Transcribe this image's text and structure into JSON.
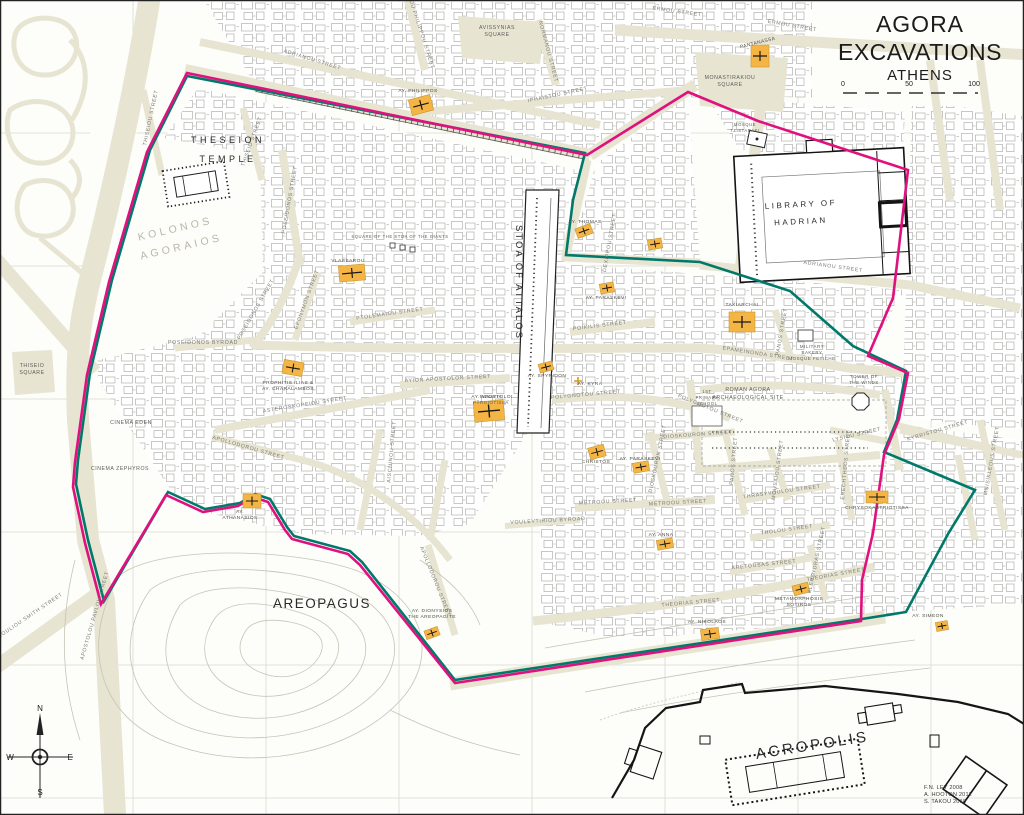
{
  "title": {
    "line1": "AGORA",
    "line2": "EXCAVATIONS",
    "line3": "ATHENS"
  },
  "scale_bar": {
    "tick0": "0",
    "tick50": "50",
    "tick100": "100"
  },
  "compass": {
    "n": "N",
    "e": "E",
    "s": "S",
    "w": "W"
  },
  "credits": {
    "line1": "F.N. LEY 2008",
    "line2": "A. HOOTON 2012",
    "line3": "S. TAKOU 2018"
  },
  "colors": {
    "boundary_magenta": "#e0107f",
    "boundary_teal": "#00796b",
    "church": "#f4b545",
    "street": "#e7e4d1",
    "contour": "#c6c4b6",
    "grid": "#dadad0"
  },
  "major_labels": {
    "theseion_1": "THESEION",
    "theseion_2": "TEMPLE",
    "kolonos_1": "KOLONOS",
    "kolonos_2": "AGORAIOS",
    "library_1": "LIBRARY OF",
    "library_2": "HADRIAN",
    "stoa": "STOA OF ATTALOS",
    "areopagus": "AREOPAGUS",
    "acropolis": "ACROPOLIS"
  },
  "area_labels": {
    "monastiraki_1": "MONASTIRAKIOU",
    "monastiraki_2": "SQUARE",
    "avissynias_1": "AVISSYNIAS",
    "avissynias_2": "SQUARE",
    "thiseio_1": "THISEIO",
    "thiseio_2": "SQUARE",
    "giants": "SQUARE OF THE STOA OF THE GIANTS",
    "roman_1": "ROMAN AGORA",
    "roman_2": "ARCHAEOLOGICAL SITE",
    "military_1": "MILITARY",
    "military_2": "BAKERY",
    "military_3": "MOSQUE FETICHE",
    "tower_1": "TOWER OF",
    "tower_2": "THE WINDS",
    "school_1": "1ST",
    "school_2": "PRIMARY",
    "school_3": "SCHOOL",
    "mosque_1": "MOSQUE",
    "mosque_2": "TZISTARAKI",
    "cinema_eden": "CINEMA EDEN",
    "cinema_zephyros": "CINEMA ZEPHYROS",
    "pyrgiotissa_1": "PANAYIA",
    "pyrgiotissa_2": "PYRGIOTISSA"
  },
  "churches": {
    "pantanassa": "PANTANASSA",
    "philippos": "AY. PHILIPPOS",
    "vlassarou": "VLASSAROU",
    "thomas": "AY. THOMAS",
    "paraskevi_n": "AY. PARASKEVI",
    "prophitis_1": "PROPHITIS ILIAS &",
    "prophitis_2": "AY. CHARALAMBOS",
    "taxiarchai": "TAXIARCHAI",
    "spyridon": "AY. SPYRIDON",
    "kyra": "AY. KYRA",
    "apostoloi": "AY. APOSTOLOI",
    "christos": "CHRISTOS",
    "paraskevi_s": "AY. PARASKEVI",
    "anna": "AY. ANNA",
    "metamorphosis_1": "METAMORPHOSIS",
    "metamorphosis_2": "SOTIROS",
    "nikolaos": "AY. NIKOLAOS",
    "dionysios_1": "AY. DIONYSIOS",
    "dionysios_2": "THE AREOPAGITE",
    "athanasios_1": "AY.",
    "athanasios_2": "ATHANASIOS",
    "chrysokastriotissa": "CHRYSOKASTRIOTISSA",
    "simeon": "AY. SIMEON"
  },
  "streets": [
    "ERMOU STREET",
    "ERMOU STREET",
    "ADRIANOU STREET",
    "IPHAISTOU STREET",
    "NORMANOU STREET",
    "AYIOU PHILIPPOU STREET",
    "THISEIOU STREET",
    "THISEIO STREET",
    "POSEIDONOS STREET",
    "POSEIDONOS STREET",
    "POSEIDONOS BYROAD",
    "EPONYMON STREET",
    "PTOLEMAIOU STREET",
    "ASTEROSKOPEIOU STREET",
    "APOLLODOROU STREET",
    "APOLLODOROU STREET",
    "AYION APOSTOLON STREET",
    "POLYGNOTOU STREET",
    "POLYGNOTOU STREET",
    "POIKILIS STREET",
    "DEXIPPOU STREET",
    "ADRIANOU STREET",
    "EPAMEINONDA STREET",
    "PANOS STREET",
    "PANOS STREET",
    "METROOU STREET",
    "METROOU STREET",
    "VOULEVTIRIOU BYROAD",
    "DIOSKOURON STREET",
    "DIOSKOURON STREET",
    "MOUSAIOU STREET",
    "THRASYVOULOU STREET",
    "THOLOU STREET",
    "ARETOUSAS STREET",
    "THEORIAS STREET",
    "THEORIAS STREET",
    "KLEPSYDRAS STREET",
    "KYRRISTOU STREET",
    "LYSIOU STREET",
    "MNISIKLEOUS STREET",
    "ERECHTHEOS STREET",
    "IOULIOU SMITH STREET",
    "APOSTOLOU PAVLOU STREET",
    "AISCHINOU STREET"
  ]
}
